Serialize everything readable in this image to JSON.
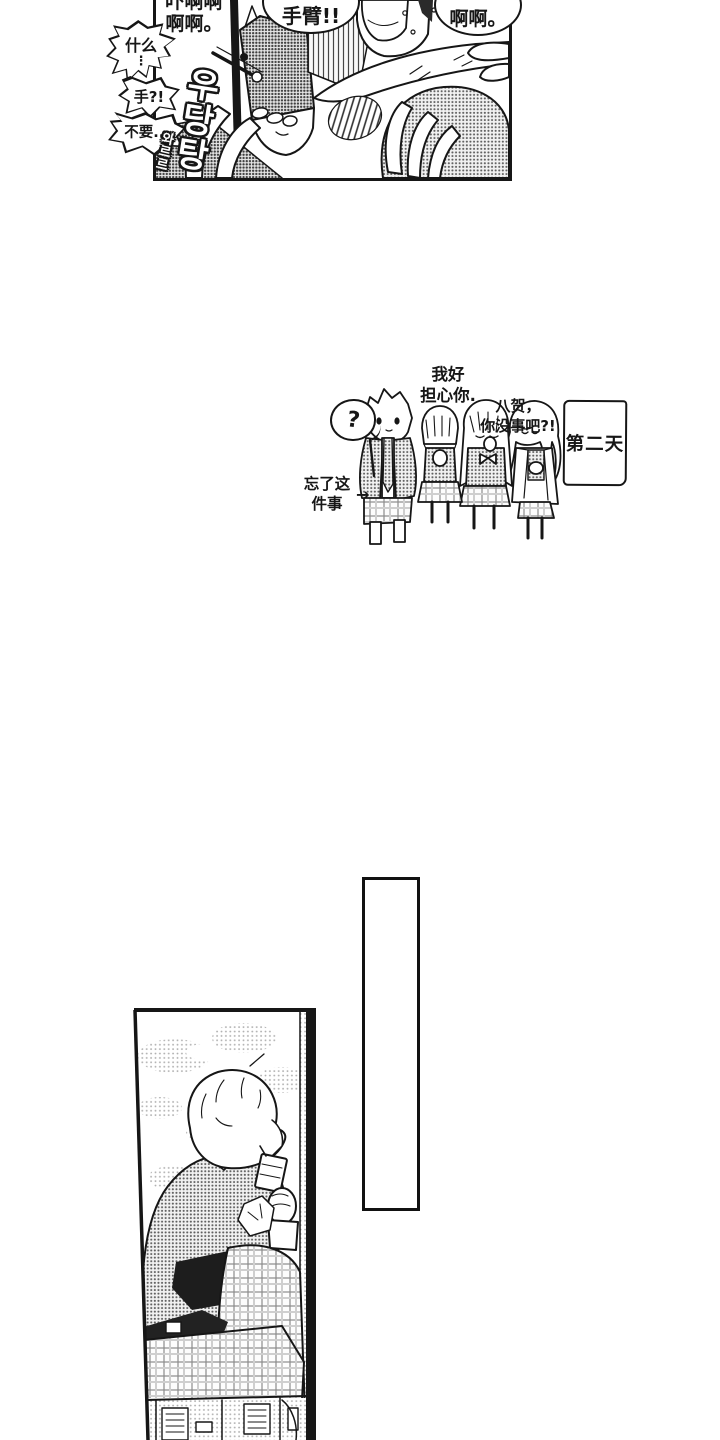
{
  "palette": {
    "ink": "#161616",
    "paper": "#ffffff",
    "halftone": "#6a6a6a"
  },
  "top_panel": {
    "scream_left": {
      "line1": "吓啊啊",
      "line2": "啊啊。"
    },
    "arm_shout": "手臂!!",
    "scream_right": "啊啊。",
    "what_bubble": {
      "line1": "什么",
      "line2": "⋮",
      "line3": "手?!"
    },
    "dont_bubble": "不要...",
    "sfx_crash": "우당탕",
    "sfx_tumble": "와르르"
  },
  "middle_scene": {
    "question_mark": "?",
    "worry": {
      "line1": "我好",
      "line2": "担心你."
    },
    "name_call": {
      "line1": "八贺，",
      "line2": "你没事吧?!"
    },
    "caption": {
      "line1": "忘了这",
      "line2": "件事",
      "arrow": "→"
    },
    "day_label": "第二天"
  }
}
